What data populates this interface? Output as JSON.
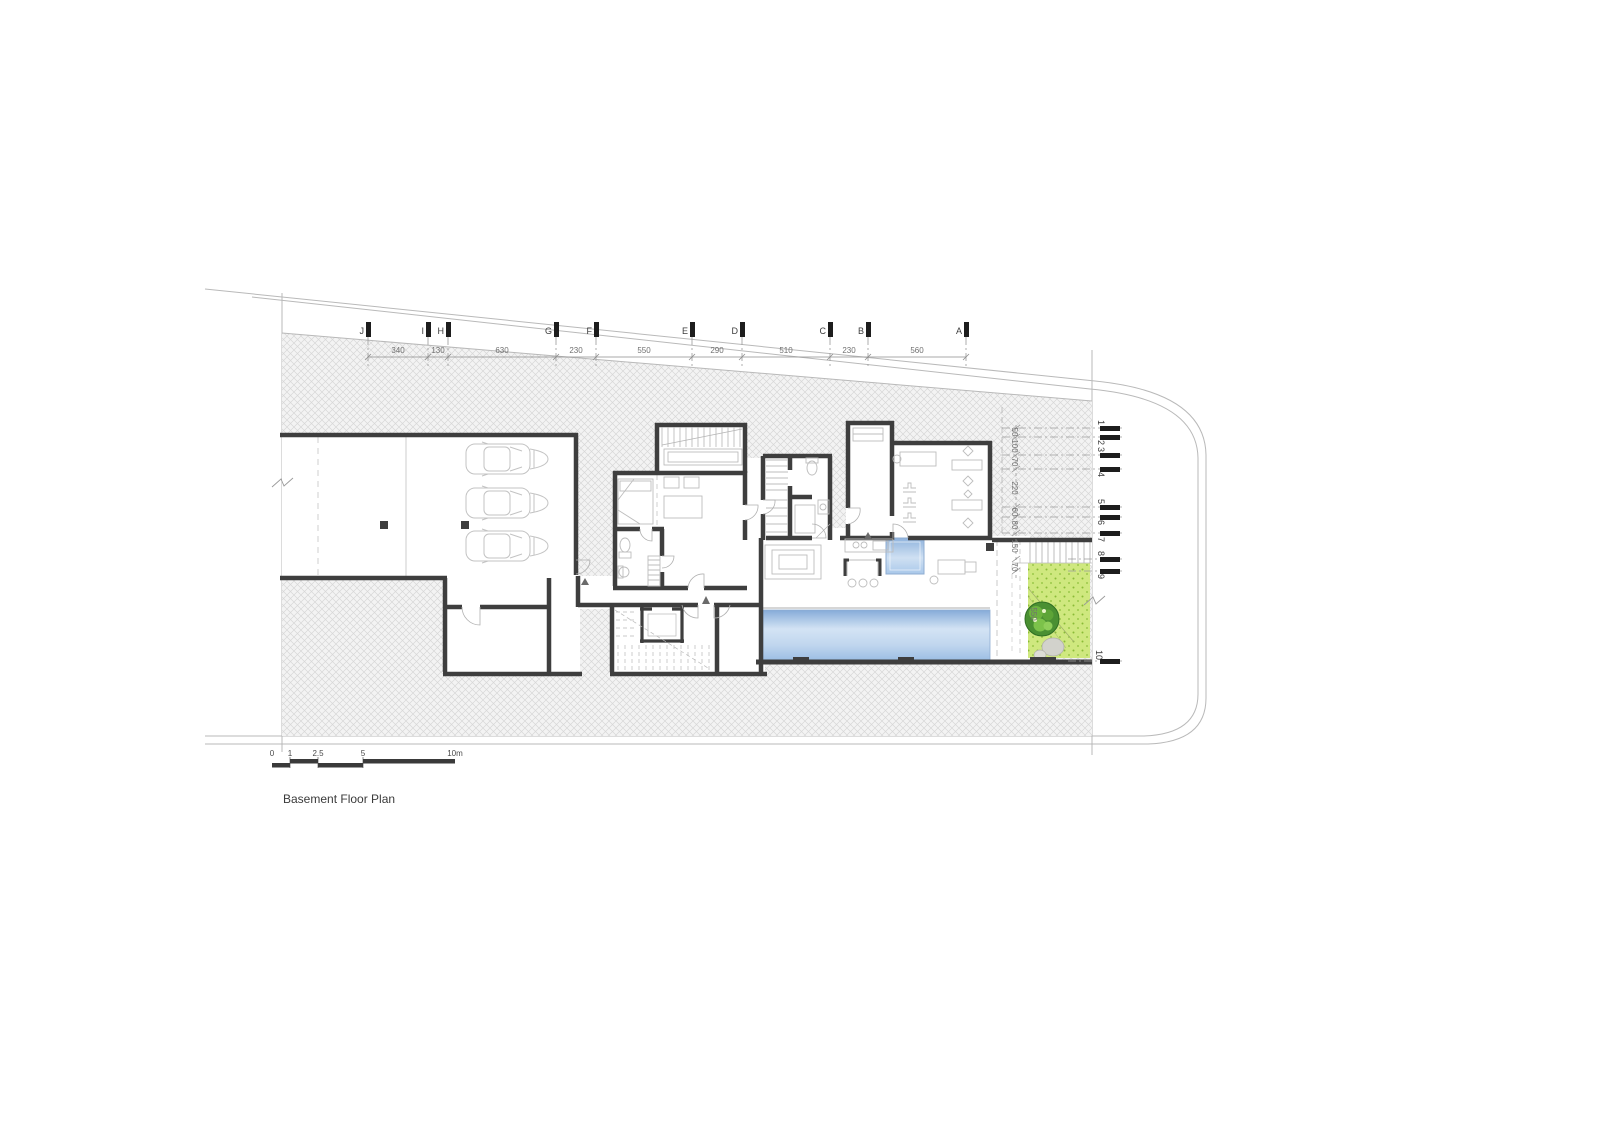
{
  "title": "Basement Floor Plan",
  "grid_top": {
    "letters": [
      "J",
      "I",
      "H",
      "G",
      "F",
      "E",
      "D",
      "C",
      "B",
      "A"
    ],
    "dims": [
      "340",
      "130",
      "630",
      "230",
      "550",
      "290",
      "510",
      "230",
      "560"
    ]
  },
  "grid_right": {
    "numbers": [
      "1",
      "2",
      "3",
      "4",
      "5",
      "6",
      "7",
      "8",
      "9",
      "10"
    ],
    "dims": [
      "50",
      "100",
      "70",
      "220",
      "60",
      "80",
      "150",
      "70"
    ],
    "garden_dim": "550"
  },
  "scalebar": {
    "labels": [
      "0",
      "1",
      "2.5",
      "5",
      "10m"
    ]
  },
  "colors": {
    "wall": "#3e3e3e",
    "thin_line": "#b5b5b5",
    "furniture": "#c3c3c3",
    "hatch_line": "#d0d0d0",
    "pool_dark": "#85abd8",
    "pool_light": "#d3e3f4",
    "garden_green": "#cfe87f",
    "garden_dot": "#7ab32e",
    "tree_green": "#4a9032",
    "tree_light": "#8fce5a",
    "bush_gray": "#d2d2cc"
  }
}
